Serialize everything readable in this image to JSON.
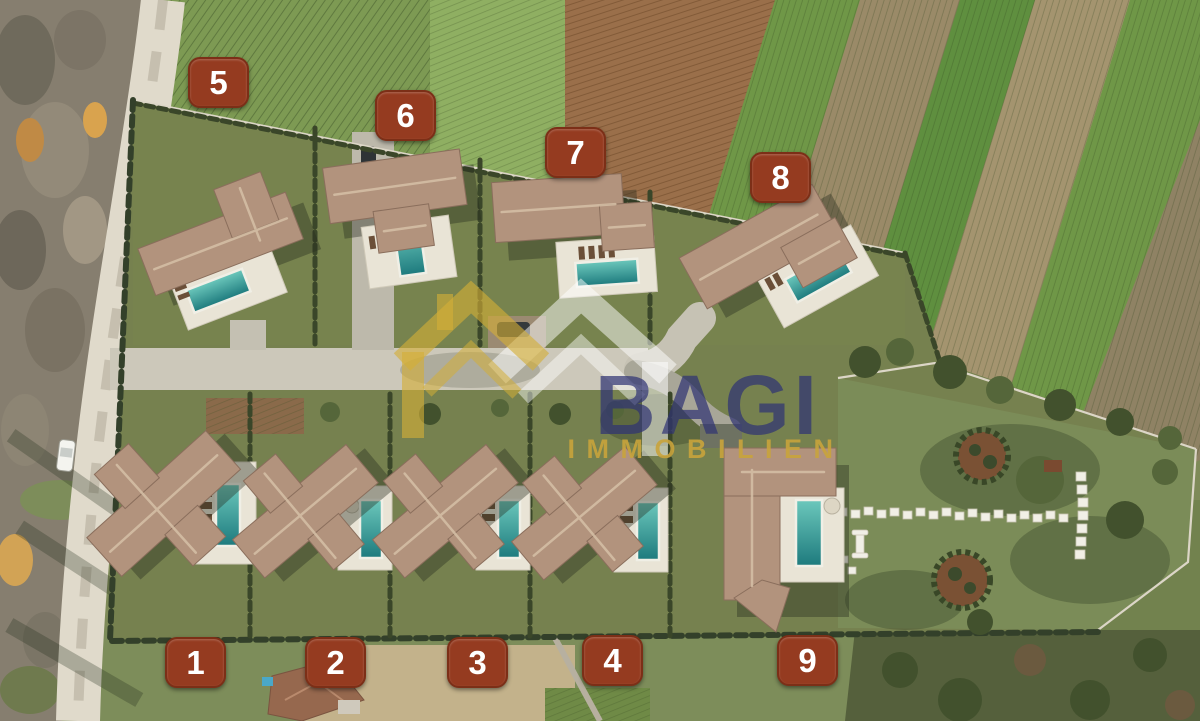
{
  "watermark": {
    "brand": "BAGI",
    "tagline": "IMMOBILIEN",
    "brand_color": "#2e3274",
    "tagline_color": "#c9a43c",
    "logo": "double-house-roof-logo",
    "logo_gold": "#d4af37",
    "logo_white": "#ffffff"
  },
  "plots": {
    "p1": {
      "label": "1"
    },
    "p2": {
      "label": "2"
    },
    "p3": {
      "label": "3"
    },
    "p4": {
      "label": "4"
    },
    "p5": {
      "label": "5"
    },
    "p6": {
      "label": "6"
    },
    "p7": {
      "label": "7"
    },
    "p8": {
      "label": "8"
    },
    "p9": {
      "label": "9"
    }
  },
  "palette": {
    "badge_bg": "#953b20",
    "badge_border": "#7c2f17",
    "badge_text": "#ffffff",
    "pool_water": "#2f9094",
    "lawn": "#76814f",
    "roof": "#b2937d",
    "road_external": "#e0dacb",
    "road_internal": "#ccc8ba"
  }
}
